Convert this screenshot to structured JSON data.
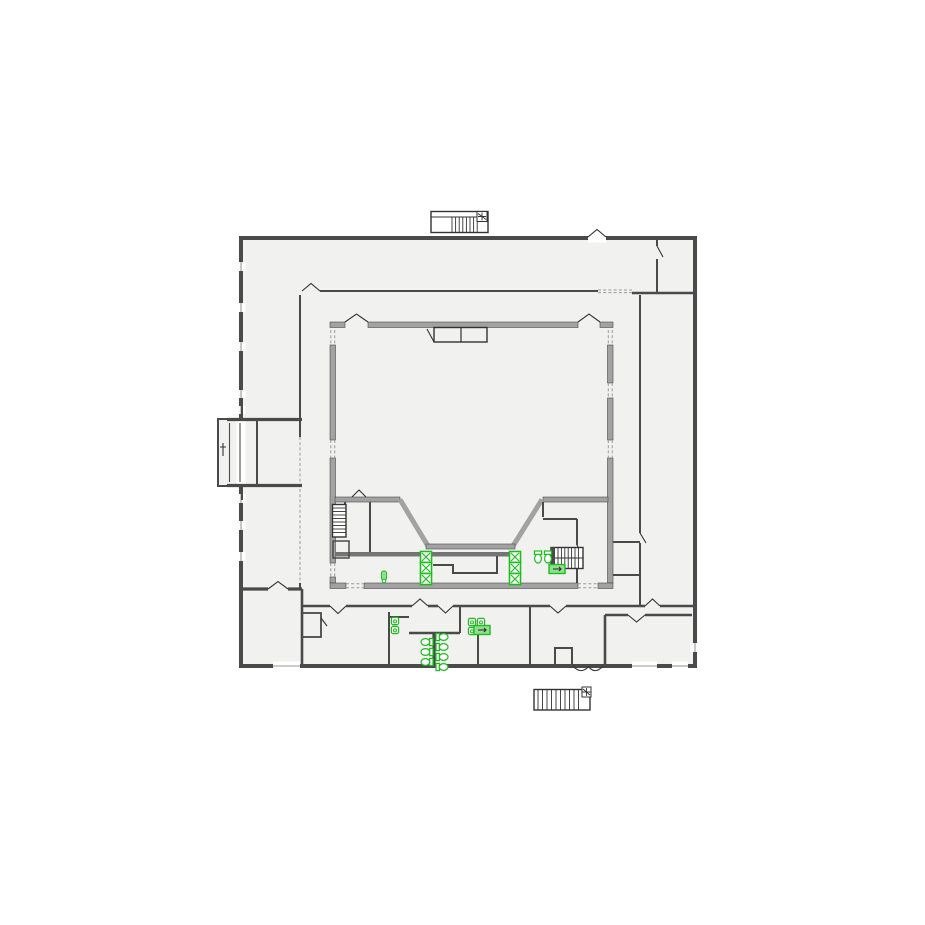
{
  "canvas": {
    "width": 925,
    "height": 925,
    "background": "#ffffff"
  },
  "colors": {
    "bg": "#ffffff",
    "floor": "#f1f1ef",
    "wallDark": "#4a4a4a",
    "wallMed": "#747474",
    "wallGray": "#a2a2a2",
    "line": "#333333",
    "dash": "#9a9a9a",
    "green": "#1ebc1e",
    "greenFill": "#8fdf8f"
  },
  "plan": {
    "kind": "architectural-floor-plan",
    "visible_text": [],
    "features": {
      "exterior_stairs": [
        "top-center stair with treads and landing marker",
        "bottom-center stair with treads and landing marker"
      ],
      "interior_stairs": [
        "small stair inner south-west",
        "stair inner south-east"
      ],
      "entry_porch": "left side projecting vestibule",
      "central_hall": "large inner hall with splayed stage front at south",
      "restrooms": "south band toilet room with stall toilets, sinks and urinals",
      "shafts": "two columns of three x-boxed shafts on the south corridor wall"
    }
  },
  "fixtures": {
    "stroke": "#1ebc1e",
    "items": [
      {
        "kind": "shaft",
        "x": 426,
        "y": 557
      },
      {
        "kind": "shaft",
        "x": 426,
        "y": 568
      },
      {
        "kind": "shaft",
        "x": 426,
        "y": 579
      },
      {
        "kind": "shaft",
        "x": 515,
        "y": 557
      },
      {
        "kind": "shaft",
        "x": 515,
        "y": 568
      },
      {
        "kind": "shaft",
        "x": 515,
        "y": 579
      },
      {
        "kind": "toilet",
        "x": 538,
        "y": 557,
        "rot": 90
      },
      {
        "kind": "toilet",
        "x": 548,
        "y": 557,
        "rot": 90
      },
      {
        "kind": "toilet",
        "x": 427,
        "y": 642,
        "rot": 180
      },
      {
        "kind": "toilet",
        "x": 427,
        "y": 652,
        "rot": 180
      },
      {
        "kind": "toilet",
        "x": 427,
        "y": 662,
        "rot": 180
      },
      {
        "kind": "toilet",
        "x": 442,
        "y": 637,
        "rot": 0
      },
      {
        "kind": "toilet",
        "x": 442,
        "y": 647,
        "rot": 0
      },
      {
        "kind": "toilet",
        "x": 442,
        "y": 657,
        "rot": 0
      },
      {
        "kind": "toilet",
        "x": 442,
        "y": 667,
        "rot": 0
      },
      {
        "kind": "sink",
        "x": 395,
        "y": 621,
        "rot": 0
      },
      {
        "kind": "sink",
        "x": 395,
        "y": 630,
        "rot": 0
      },
      {
        "kind": "sink",
        "x": 472,
        "y": 622,
        "rot": 0
      },
      {
        "kind": "sink",
        "x": 481,
        "y": 622,
        "rot": 0
      },
      {
        "kind": "sink",
        "x": 472,
        "y": 631,
        "rot": 0
      },
      {
        "kind": "accbox",
        "x": 482,
        "y": 630,
        "rot": 0
      },
      {
        "kind": "accbox",
        "x": 557,
        "y": 569,
        "rot": 0
      },
      {
        "kind": "drain",
        "x": 384,
        "y": 577,
        "rot": 0
      }
    ]
  }
}
